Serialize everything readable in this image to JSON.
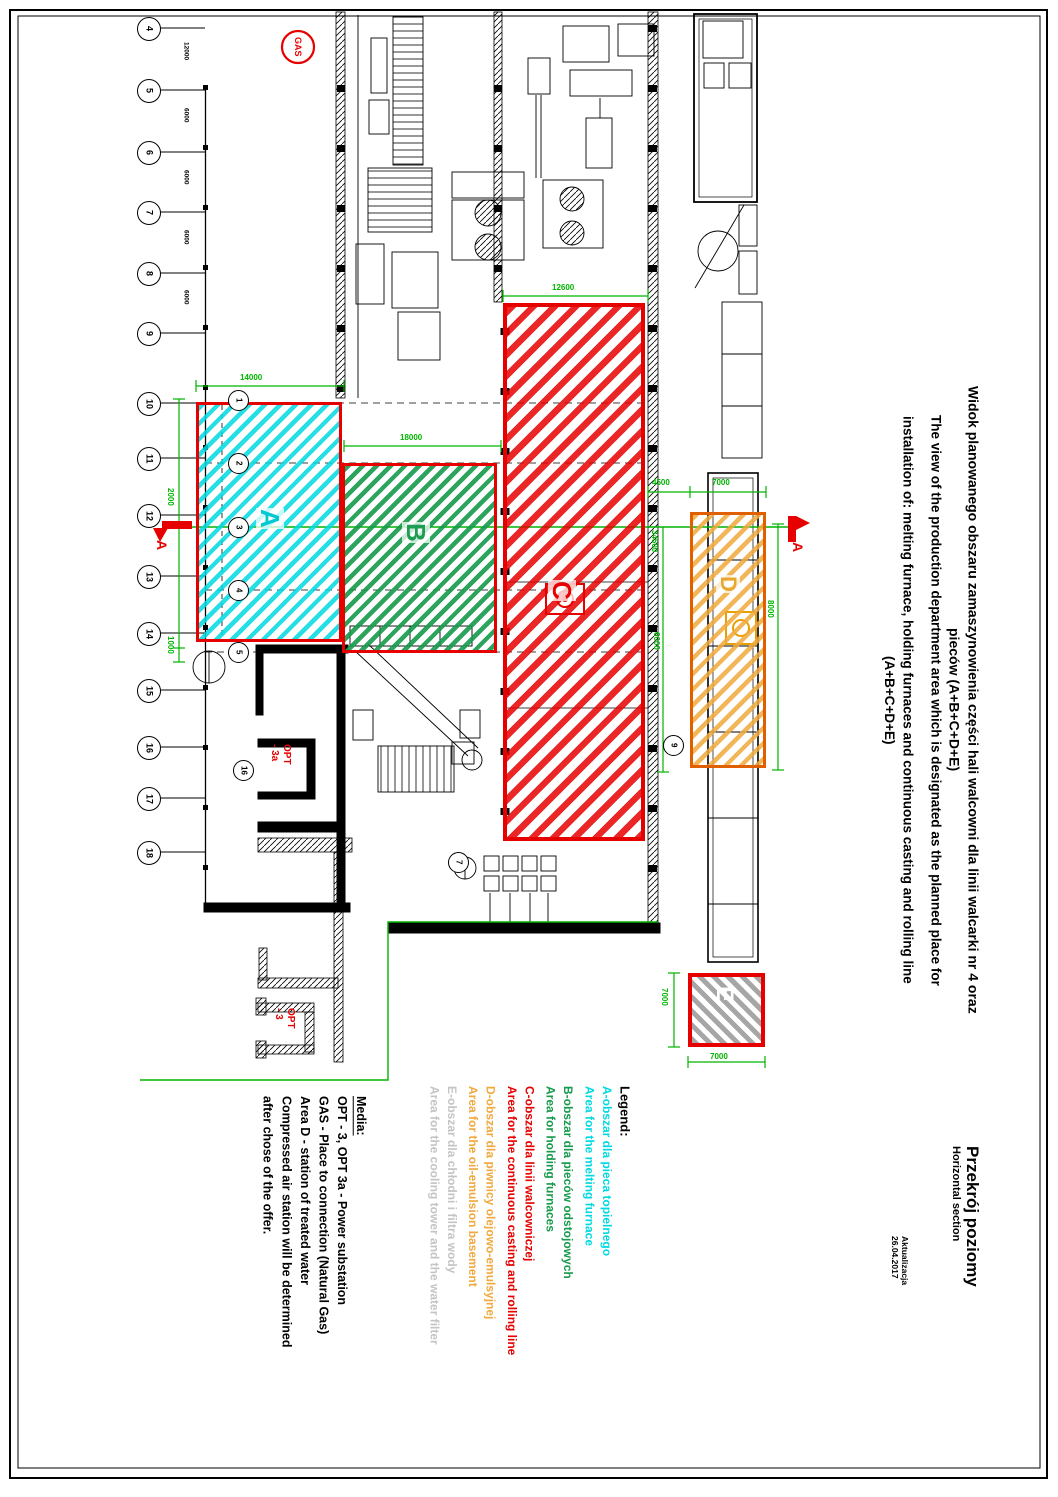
{
  "title_block": {
    "pl_line1": "Widok planowanego obszaru zamaszynowienia części hali walcowni dla linii walcarki nr 4 oraz",
    "pl_line2": "pieców  (A+B+C+D+E)",
    "en_line1": "The view of the production department area which is designated as the planned place for",
    "en_line2": "installation of: melting furnace, holding furnaces and continuous casting and rolling line",
    "en_line3": "(A+B+C+D+E)"
  },
  "corner": {
    "section_pl": "Przekrój poziomy",
    "section_en": "Horizontal section",
    "update_line1": "Aktualizacja",
    "update_line2": "26.04.2017"
  },
  "legend": {
    "heading": "Legend:",
    "entries": [
      {
        "id": "A",
        "color": "#00D9E1",
        "pl": "A-obszar dla pieca topielnego",
        "en": "Area for the melting furnace"
      },
      {
        "id": "B",
        "color": "#169A4C",
        "pl": "B-obszar dla pieców odstojowych",
        "en": "Area for holding furnaces"
      },
      {
        "id": "C",
        "color": "#E60000",
        "pl": "C-obszar dla linii walcowniczej",
        "en": "Area for the continuous casting and rolling line"
      },
      {
        "id": "D",
        "color": "#F0A93C",
        "pl": "D-obszar dla piwnicy olejowo-emulsyjnej",
        "en": "Area for the oil-emulsion basement"
      },
      {
        "id": "E",
        "color": "#C4C4C4",
        "pl": "E-obszar dla chłodni i filtra wody",
        "en": "Area for the cooling tower and the water filter"
      }
    ]
  },
  "media": {
    "heading": "Media:",
    "lines": [
      "OPT - 3, OPT 3a - Power substation",
      "GAS - Place to connection (Natural Gas)",
      "Area D - station of treated water",
      "Compressed air station will be determined",
      "after chose of the offer."
    ]
  },
  "areas": [
    {
      "id": "A",
      "label": "A",
      "color": "#00D9E1"
    },
    {
      "id": "B",
      "label": "B",
      "color": "#169A4C"
    },
    {
      "id": "C",
      "label": "C",
      "color": "#E60000"
    },
    {
      "id": "D",
      "label": "D",
      "color": "#F0A93C"
    },
    {
      "id": "E",
      "label": "E",
      "color": "#BDBDBD"
    }
  ],
  "grid": {
    "left_bubbles": [
      "4",
      "5",
      "6",
      "7",
      "8",
      "9",
      "10",
      "11",
      "12",
      "13",
      "14",
      "15",
      "16",
      "17",
      "18"
    ],
    "inner_bubbles": [
      "1",
      "2",
      "3",
      "4",
      "5"
    ],
    "extra_bubbles": [
      "9",
      "16",
      "7"
    ],
    "left_dims": [
      "12000",
      "6000",
      "6000",
      "6000",
      "6000"
    ]
  },
  "dimensions": {
    "a_width": "14000",
    "b_width": "18000",
    "c_width": "12600",
    "a_offset": "2000",
    "a_gap": "1000",
    "cd_gap": "4500",
    "d_width": "7000",
    "c_height": "34500",
    "cd_height": "6000",
    "d_height": "8000",
    "e_height": "7000",
    "e_width": "7000"
  },
  "markers": {
    "gas": "GAS",
    "opt3a_l1": "OPT",
    "opt3a_l2": "- 3a",
    "opt3_l1": "OPT",
    "opt3_l2": "- 3",
    "section_left": "A",
    "section_right": "A"
  }
}
